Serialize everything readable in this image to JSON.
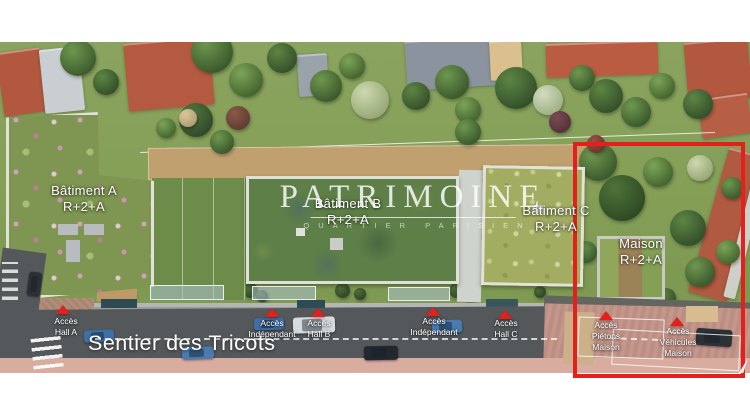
{
  "watermark": {
    "title": "PATRIMOINE",
    "subtitle": "QUARTIER PARISIEN"
  },
  "buildings": [
    {
      "name": "Bâtiment A",
      "level": "R+2+A"
    },
    {
      "name": "Bâtiment B",
      "level": "R+2+A"
    },
    {
      "name": "Bâtiment C",
      "level": "R+2+A"
    },
    {
      "name": "Maison",
      "level": "R+2+A"
    }
  ],
  "street": {
    "name": "Sentier des Tricots"
  },
  "access_points": [
    {
      "line1": "Accès",
      "line2": "Hall A"
    },
    {
      "line1": "Accès",
      "line2": "Indépendant"
    },
    {
      "line1": "Accès",
      "line2": "Hall B"
    },
    {
      "line1": "Accès",
      "line2": "Indépendant"
    },
    {
      "line1": "Accès",
      "line2": "Hall C"
    },
    {
      "line1": "Accès",
      "line2": "Piétons",
      "line3": "Maison"
    },
    {
      "line1": "Accès",
      "line2": "Véhicules",
      "line3": "Maison"
    }
  ],
  "annotations": {
    "highlight_box_color": "#e3201b",
    "arrow_color": "#e3201b",
    "label_text_color": "#ffffff"
  }
}
